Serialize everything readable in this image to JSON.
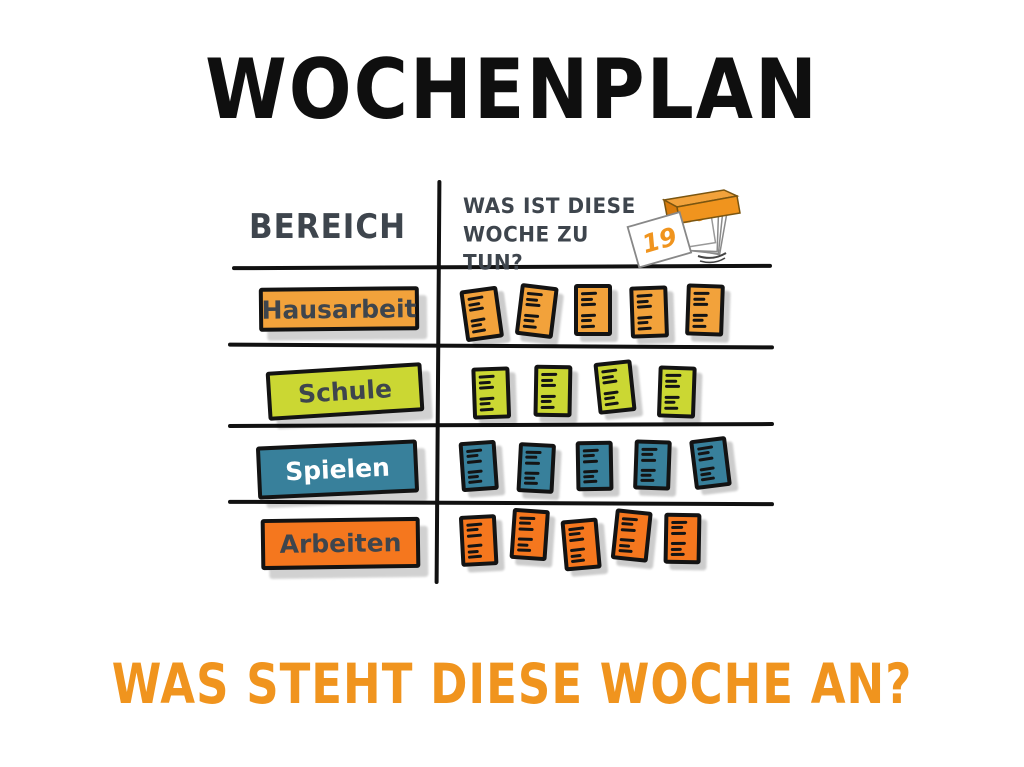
{
  "title": "WOCHENPLAN",
  "footer_question": "WAS STEHT DIESE WOCHE AN?",
  "table": {
    "col1_header": "BEREICH",
    "col2_header": {
      "line1": "WAS IST DIESE",
      "line2": "WOCHE ZU TUN?"
    },
    "calendar_icon": {
      "name": "tear-off-calendar-icon",
      "front_page_number": "19",
      "back_page_number": "20"
    },
    "rows": [
      {
        "label": "Hausarbeit",
        "note_count": 5,
        "color": "#f2a23b",
        "label_text_color": "#3e454d"
      },
      {
        "label": "Schule",
        "note_count": 4,
        "color": "#cbd733",
        "label_text_color": "#3e454d"
      },
      {
        "label": "Spielen",
        "note_count": 5,
        "color": "#38809b",
        "label_text_color": "#ffffff"
      },
      {
        "label": "Arbeiten",
        "note_count": 5,
        "color": "#f5771e",
        "label_text_color": "#3e454d"
      }
    ]
  },
  "colors": {
    "title_text": "#0f0f0f",
    "header_text": "#3e454d",
    "footer_text": "#f0941e",
    "table_lines": "#111111",
    "calendar_orange": "#f0941e"
  }
}
